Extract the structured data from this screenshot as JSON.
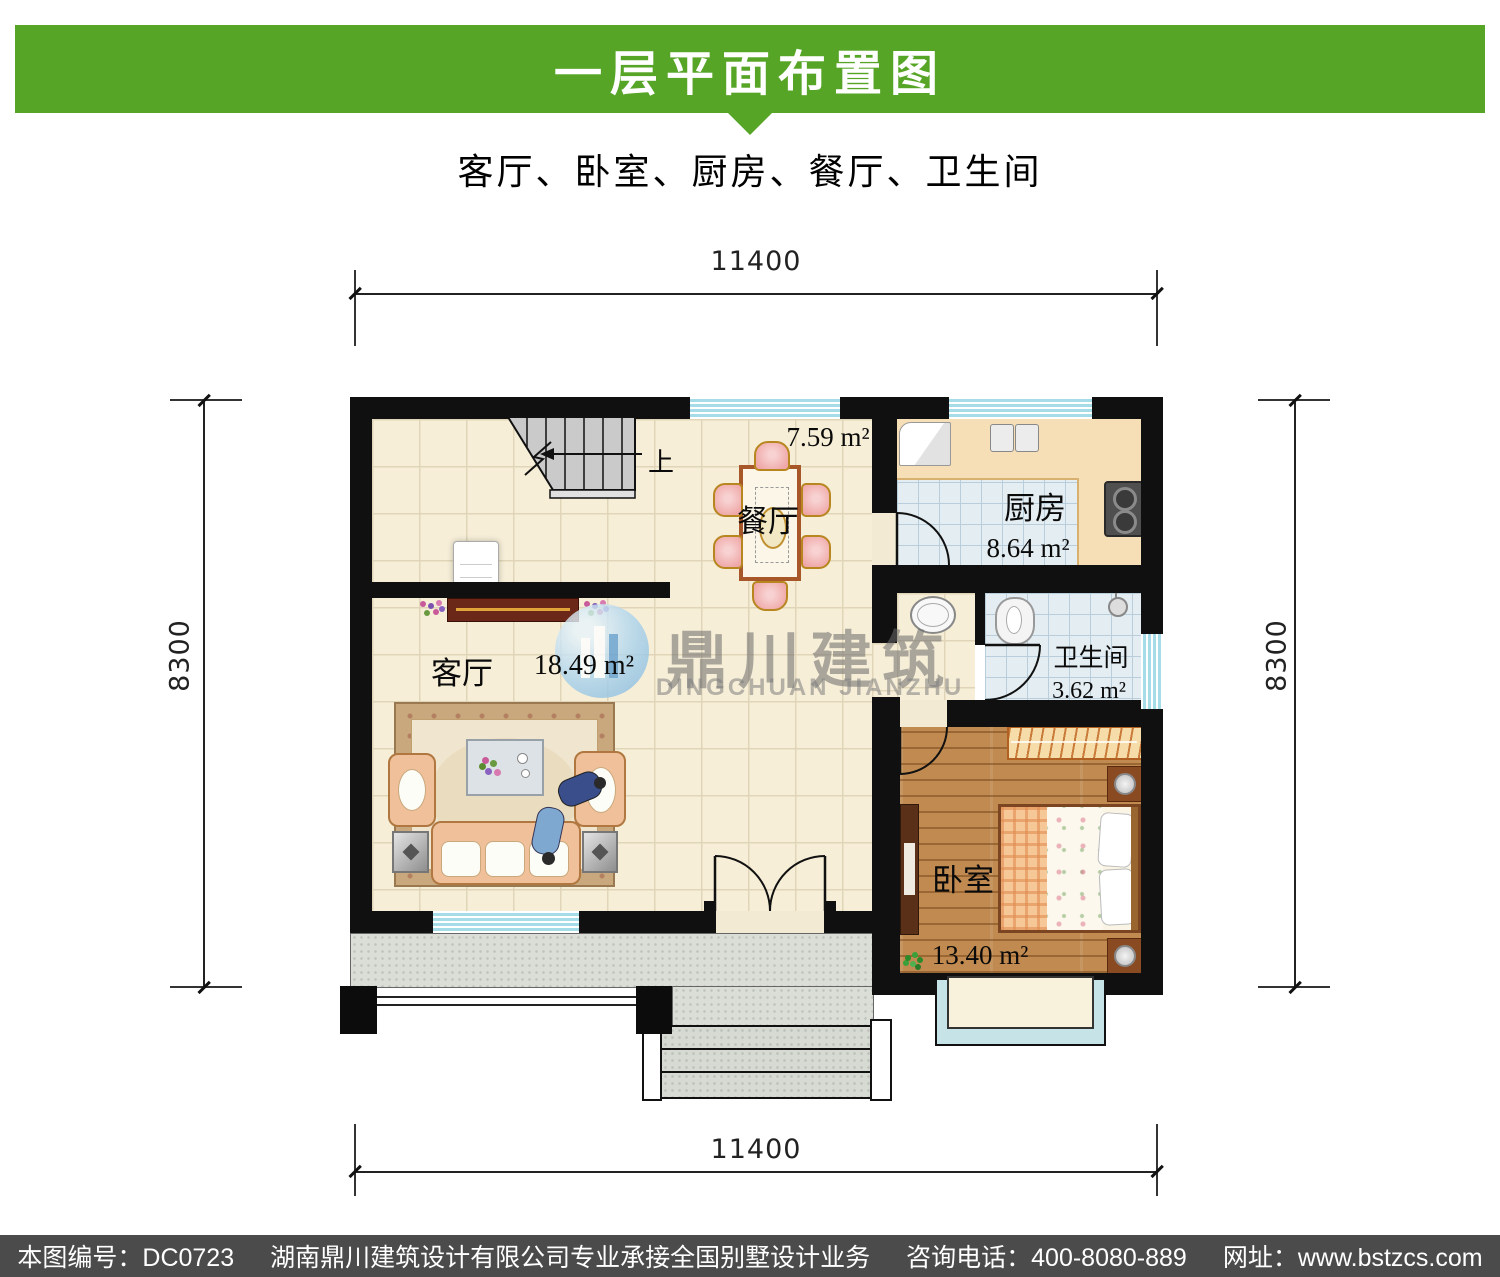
{
  "header": {
    "title": "一层平面布置图",
    "subtitle": "客厅、卧室、厨房、餐厅、卫生间"
  },
  "dimensions": {
    "top": "11400",
    "bottom": "11400",
    "left": "8300",
    "right": "8300"
  },
  "rooms": {
    "dining": {
      "name": "餐厅",
      "area": "7.59 m²"
    },
    "kitchen": {
      "name": "厨房",
      "area": "8.64 m²"
    },
    "bathroom": {
      "name": "卫生间",
      "area": "3.62 m²"
    },
    "living": {
      "name": "客厅",
      "area": "18.49 m²"
    },
    "bedroom": {
      "name": "卧室",
      "area": "13.40 m²"
    }
  },
  "stairs": {
    "direction_label": "上"
  },
  "watermark": {
    "name_zh": "鼎川建筑",
    "name_en": "DINGCHUAN JIANZHU"
  },
  "footer": {
    "plan_no": "本图编号：DC0723",
    "company": "湖南鼎川建筑设计有限公司专业承接全国别墅设计业务",
    "phone": "咨询电话：400-8080-889",
    "website": "网址：www.bstzcs.com"
  },
  "colors": {
    "accent_green": "#57A527",
    "footer_bg": "#4B4B4B",
    "wall": "#101010",
    "floor_beige": "#F6EED7",
    "tile_blue": "#E4EEF2",
    "wood": "#C08A50",
    "counter_tan": "#F6DFB6",
    "window_blue": "#A5DCE8",
    "terrace_gray": "#DADED7"
  }
}
